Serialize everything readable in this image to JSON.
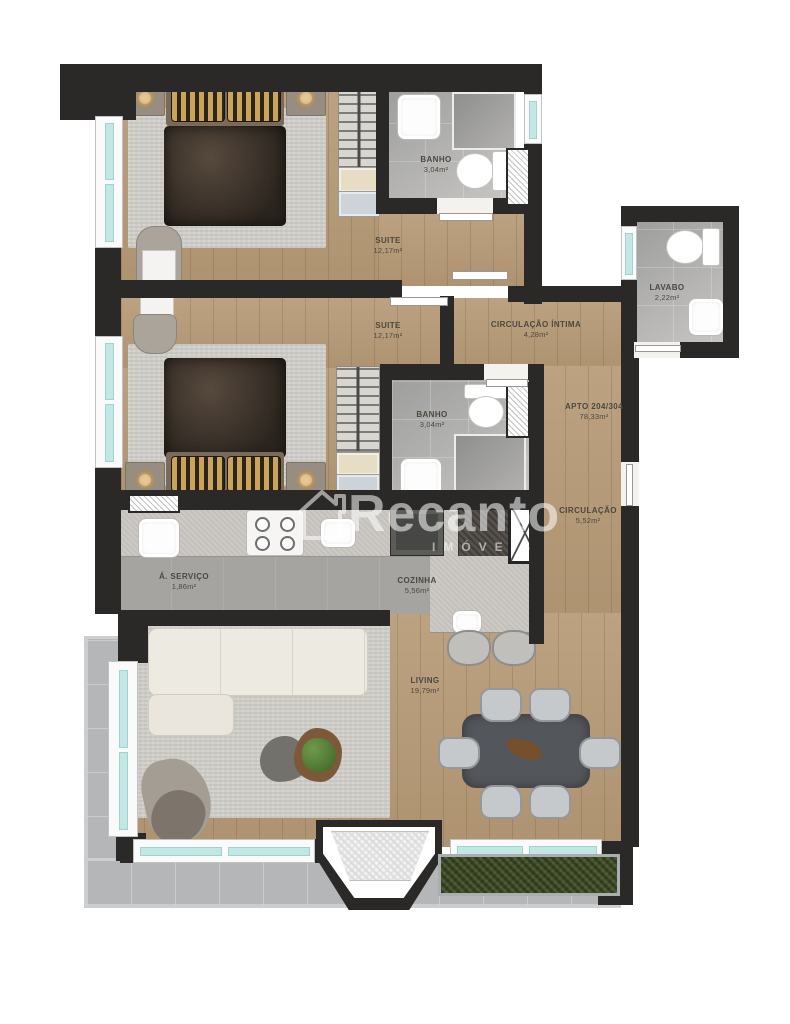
{
  "watermark": {
    "brand": "Recanto",
    "subtitle": "IMÓVEIS"
  },
  "rooms": {
    "banho1": {
      "name": "BANHO",
      "area": "3,04m²"
    },
    "suite1": {
      "name": "SUITE",
      "area": "12,17m²"
    },
    "suite2": {
      "name": "SUITE",
      "area": "12,17m²"
    },
    "intima": {
      "name": "CIRCULAÇÃO ÍNTIMA",
      "area": "4,28m²"
    },
    "lavabo": {
      "name": "LAVABO",
      "area": "2,22m²"
    },
    "banho2": {
      "name": "BANHO",
      "area": "3,04m²"
    },
    "apto": {
      "name": "APTO 204/304",
      "area": "78,33m²"
    },
    "circ": {
      "name": "CIRCULAÇÃO",
      "area": "5,52m²"
    },
    "servico": {
      "name": "Á. SERVIÇO",
      "area": "1,86m²"
    },
    "cozinha": {
      "name": "COZINHA",
      "area": "5,56m²"
    },
    "living": {
      "name": "LIVING",
      "area": "19,79m²"
    }
  },
  "colors": {
    "wall": "#2a2928",
    "wood_floor": "#b89c79",
    "glass": "#c3e7e4",
    "planter": "#46522e",
    "label_text": "#4b4840"
  }
}
